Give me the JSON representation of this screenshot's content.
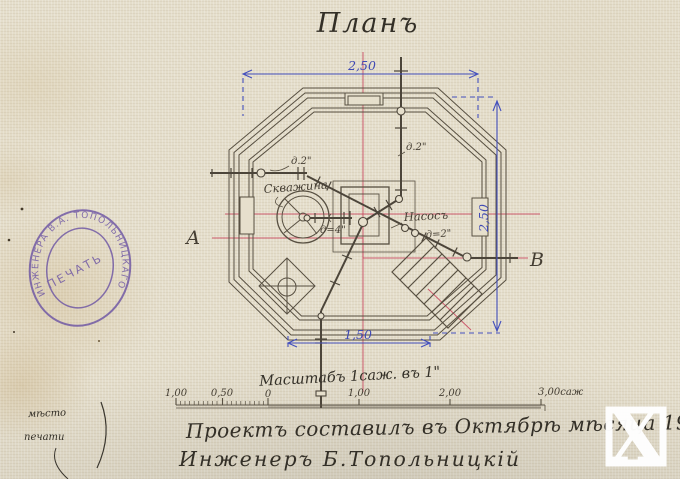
{
  "title": "Планъ",
  "plan": {
    "labels": {
      "well": "Скважина",
      "pump": "Насосъ",
      "pipe_d4": "д=4\"",
      "pipe_d2_left": "д.2\"",
      "pipe_d2_top": "д.2\"",
      "pipe_d2_right": "д=2\"",
      "section_left": "А",
      "section_right": "В"
    },
    "dimensions": {
      "top_width": "2,50",
      "right_height": "2,50",
      "bottom_width": "1,50"
    }
  },
  "scale": {
    "note": "Масштабъ 1саж. въ 1\"",
    "bar_labels": [
      "1,00",
      "0,50",
      "0",
      "1,00",
      "2,00",
      "3,00саж"
    ]
  },
  "stamp": {
    "ring_text": "ИНЖЕНЕРА  В.А.  ТОПОЛЬНИЦКАГО",
    "center_text": "ПЕЧАТЬ",
    "color": "#6d55a4"
  },
  "notes": {
    "margin_line1": "мѣсто",
    "margin_line2": "печати",
    "caption_line1": "Проектъ составилъ въ Октябрѣ мѣсяца 1911 года",
    "caption_line2": "Инженеръ Б.Топольницкій"
  },
  "watermark": {
    "letter": "X"
  },
  "colors": {
    "paper": "#e4ddca",
    "ink": "#585042",
    "centerline_red": "#c73e58",
    "dimension_blue": "#4450bd",
    "stamp_purple": "#6d55a4",
    "watermark_white": "#ffffff"
  }
}
